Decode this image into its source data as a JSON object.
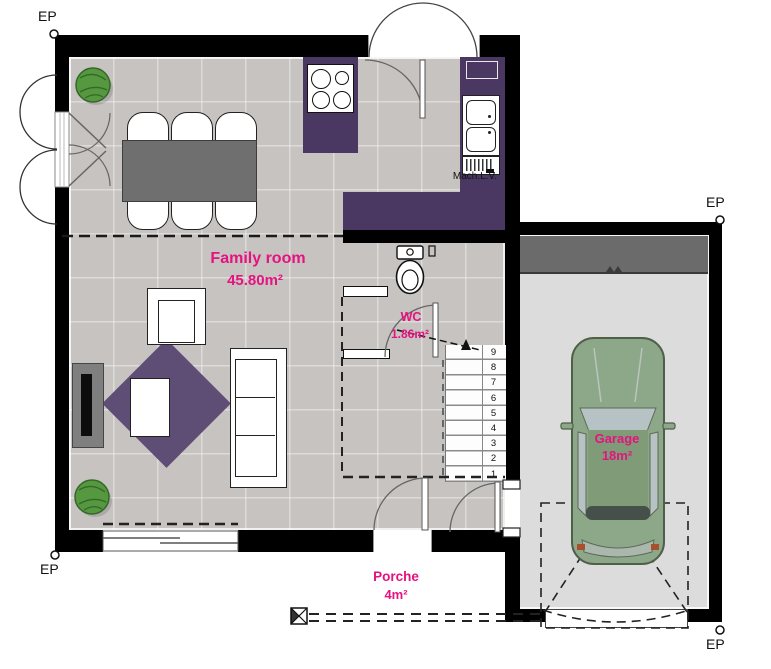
{
  "plan": {
    "corner_labels": {
      "top_left": "EP",
      "top_right": "EP",
      "bottom_left": "EP",
      "bottom_right": "EP"
    },
    "rooms": {
      "family_room": {
        "name": "Family room",
        "area": "45.80m²"
      },
      "wc": {
        "name": "WC",
        "area": "1.86m²"
      },
      "garage": {
        "name": "Garage",
        "area": "18m²"
      },
      "porch": {
        "name": "Porche",
        "area": "4m²"
      }
    },
    "appliances": {
      "dishwasher_label": "Mach.L.V."
    },
    "stairs": {
      "numbers": [
        "9",
        "8",
        "7",
        "6",
        "5",
        "4",
        "3",
        "2",
        "1"
      ]
    },
    "colors": {
      "accent_pink": "#e5127f",
      "counter_purple": "#4a3863",
      "rug_purple": "#5e4d74",
      "wall_black": "#000000",
      "floor_gray": "#c7c3c1",
      "garage_floor_gray": "#dcdcdc",
      "storage_band_gray": "#6b6b6b",
      "car_green": "#8da888"
    }
  }
}
